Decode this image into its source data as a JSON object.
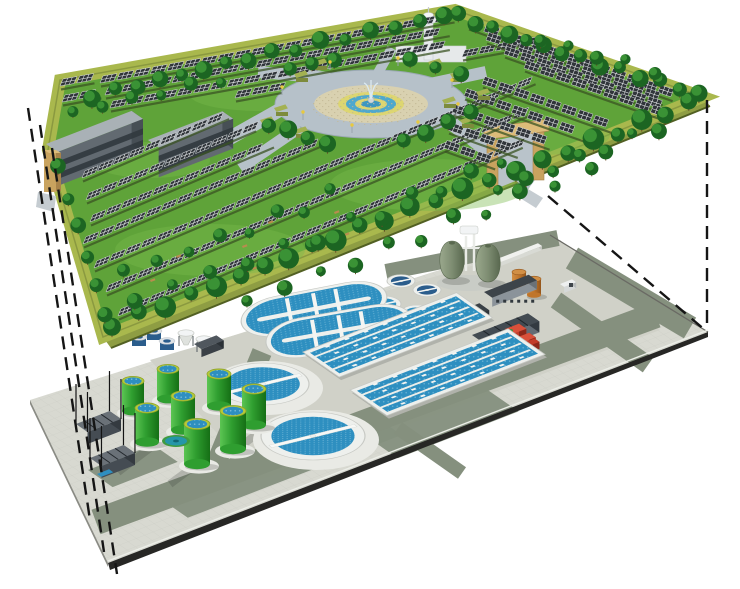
{
  "scene": {
    "title": "Exploded 3D rendering: ground-level solar park above an underground wastewater treatment plant, linked by dashed projection lines",
    "upper_level_label": "Ground level: solar-panel park with trees, central fountain plaza, office buildings and entrance gates",
    "lower_level_label": "Underground level: wastewater treatment plant with clarifiers, oxidation ditches, aeration basins, digesters and tanks"
  },
  "colors": {
    "sky": "#ffffff",
    "grass": "#5fa339",
    "grassLight": "#78b94c",
    "border": "#a9b84d",
    "borderSide": "#8a9940",
    "borderSideL": "#7b8a37",
    "borderDark": "#526023",
    "soil": "#3a5323",
    "panel": "#30353a",
    "panelGrid": "#eef0f2",
    "panelEdge": "#d7dadd",
    "treeDark": "#1c6522",
    "treeLight": "#3f9a38",
    "trunk": "#6b4a26",
    "plazaRing": "#b6c1c9",
    "plazaEdge": "#9aa8b3",
    "beige": "#d9d1b0",
    "beigeDot": "#c2b894",
    "yellow": "#ddd671",
    "blue1": "#4fa8cd",
    "blue2": "#3d97c0",
    "white": "#f2f4f5",
    "roofGray": "#a9b1b6",
    "faceGray": "#626a71",
    "sideGray": "#474f55",
    "windowDark": "#31383e",
    "tan": "#c9a35f",
    "tanDark": "#a8834a",
    "tanLight": "#ddbc79",
    "towerWhite": "#e8ebed",
    "towerShade": "#c6cccf",
    "pave": "#d8d9d1",
    "paveLine": "#c6c7bf",
    "paveMid": "#d0d1c8",
    "sage": "#85907e",
    "sageDark": "#707c6e",
    "slabEdge": "#272725",
    "slabSide": "#8a8b84",
    "cWhite": "#eef0ed",
    "cRim": "#c7c9c4",
    "water": "#2e8fc0",
    "waterDeep": "#24608c",
    "waterDot": "#a8d8ea",
    "tankGreen": "#2f9e30",
    "tankGreenD": "#156f15",
    "tankGreenL": "#5cc553",
    "tankRim": "#b5ca38",
    "egg": "#7e8d72",
    "eggD": "#59684f",
    "eggL": "#9aa88d",
    "pipe": "#e9ebe7",
    "orange": "#c0752a",
    "orangeD": "#94561c",
    "orangeL": "#d18f45",
    "red": "#c23b28",
    "redD": "#8e281a",
    "redTop": "#d9503a",
    "darkTop": "#6a7178",
    "darkFront": "#454c53",
    "darkSide": "#343a40",
    "navy": "#2b5d8c",
    "teal": "#2596a8",
    "tealRim": "#3f9a3f",
    "dash": "#151515",
    "shadow": "rgba(50,55,50,0.22)"
  },
  "upper": {
    "platform": {
      "pts": [
        [
          48,
          150
        ],
        [
          60,
          80
        ],
        [
          455,
          10
        ],
        [
          703,
          97
        ],
        [
          103,
          337
        ]
      ],
      "side_front": [
        [
          103,
          337
        ],
        [
          703,
          97
        ],
        [
          710,
          106
        ],
        [
          111,
          348
        ]
      ],
      "side_left": [
        [
          48,
          150
        ],
        [
          103,
          337
        ],
        [
          111,
          348
        ],
        [
          55,
          161
        ]
      ],
      "border_w": 12
    },
    "grass_patches": [
      [
        210,
        250,
        95,
        26
      ],
      [
        430,
        185,
        100,
        26
      ],
      [
        540,
        135,
        70,
        20
      ],
      [
        260,
        95,
        70,
        16
      ],
      [
        150,
        160,
        60,
        18
      ]
    ],
    "rows": {
      "F": {
        "dir": [
          0.92,
          -0.39
        ],
        "list": [
          [
            118,
            316,
            440
          ],
          [
            106,
            292,
            470
          ],
          [
            94,
            268,
            480
          ],
          [
            83,
            244,
            260
          ],
          [
            90,
            222,
            200
          ],
          [
            86,
            200,
            185
          ],
          [
            82,
            178,
            160
          ]
        ]
      },
      "B": {
        "dir": [
          0.985,
          -0.178
        ],
        "list": [
          [
            100,
            83,
            360
          ],
          [
            105,
            95,
            350
          ],
          [
            110,
            108,
            345
          ],
          [
            235,
            98,
            48
          ],
          [
            462,
            57,
            86
          ],
          [
            62,
            102,
            40
          ],
          [
            60,
            86,
            35
          ]
        ]
      },
      "R": {
        "dir": [
          0.93,
          0.326
        ],
        "list": [
          [
            468,
            26,
            220
          ],
          [
            486,
            40,
            190
          ],
          [
            504,
            54,
            170
          ],
          [
            524,
            68,
            150
          ],
          [
            482,
            84,
            145
          ],
          [
            464,
            96,
            130
          ],
          [
            452,
            112,
            105
          ],
          [
            448,
            130,
            75
          ],
          [
            444,
            148,
            55
          ]
        ]
      }
    },
    "panel_step": 17,
    "trees": [
      [
        112,
        324,
        690,
        103,
        24,
        7,
        11,
        4
      ],
      [
        56,
        168,
        104,
        315,
        6,
        6,
        8,
        3
      ],
      [
        88,
        96,
        440,
        16,
        16,
        6,
        9,
        4
      ],
      [
        455,
        16,
        695,
        94,
        14,
        6,
        9,
        4
      ],
      [
        268,
        124,
        330,
        144,
        4,
        7,
        9,
        3
      ],
      [
        405,
        142,
        474,
        112,
        4,
        7,
        9,
        3
      ],
      [
        292,
        68,
        336,
        60,
        3,
        6,
        8,
        2
      ],
      [
        412,
        60,
        462,
        74,
        3,
        6,
        8,
        2
      ],
      [
        140,
        298,
        510,
        162,
        12,
        5,
        8,
        10
      ],
      [
        122,
        272,
        330,
        195,
        8,
        5,
        7,
        9
      ],
      [
        240,
        300,
        600,
        170,
        11,
        5,
        8,
        9
      ],
      [
        492,
        190,
        664,
        127,
        7,
        5,
        8,
        6
      ],
      [
        70,
        112,
        225,
        80,
        6,
        5,
        7,
        4
      ],
      [
        540,
        40,
        660,
        70,
        5,
        5,
        7,
        5
      ]
    ],
    "plaza": {
      "cx": 371,
      "cy": 104,
      "rings": [
        [
          96,
          34,
          "plazaRing"
        ],
        [
          57,
          19,
          "beige"
        ],
        [
          33,
          12,
          "yellow"
        ],
        [
          25,
          9,
          "blue1"
        ],
        [
          16,
          5.8,
          "yellow"
        ],
        [
          10,
          3.6,
          "blue2"
        ]
      ]
    },
    "paths": [
      [
        330,
        78,
        258,
        72,
        12
      ],
      [
        430,
        84,
        486,
        72,
        12
      ],
      [
        300,
        127,
        240,
        168,
        12
      ],
      [
        447,
        120,
        532,
        184,
        14
      ],
      [
        378,
        73,
        392,
        48,
        10
      ],
      [
        292,
        103,
        212,
        148,
        14
      ]
    ],
    "hedges": [
      [
        315,
        62
      ],
      [
        296,
        74
      ],
      [
        430,
        62
      ],
      [
        452,
        74
      ],
      [
        276,
        108
      ],
      [
        296,
        130
      ],
      [
        444,
        100
      ],
      [
        462,
        120
      ],
      [
        262,
        120
      ],
      [
        478,
        92
      ]
    ],
    "lamps": [
      [
        303,
        120
      ],
      [
        352,
        133
      ],
      [
        418,
        130
      ],
      [
        458,
        112
      ],
      [
        330,
        70
      ],
      [
        398,
        66
      ],
      [
        282,
        95
      ],
      [
        452,
        88
      ]
    ],
    "benches": [
      [
        160,
        302
      ],
      [
        252,
        268
      ],
      [
        344,
        234
      ],
      [
        150,
        280
      ],
      [
        242,
        246
      ],
      [
        334,
        212
      ],
      [
        176,
        256
      ],
      [
        268,
        222
      ]
    ],
    "buildings": [
      [
        46,
        178,
        92,
        14,
        34
      ],
      [
        148,
        170,
        80,
        13,
        30
      ]
    ],
    "tower": {
      "shaft": [
        424,
        22,
        9,
        38
      ],
      "cap": [
        428.5,
        20,
        8,
        4
      ],
      "top": [
        428.5,
        15,
        5,
        2.5
      ],
      "spire": [
        428.5,
        7,
        428.5,
        14
      ]
    },
    "back_building": [
      396,
      46,
      70,
      16
    ],
    "gate_left": {
      "x": 44,
      "y": 150,
      "w": 12,
      "h": 42
    },
    "gate_right": {
      "p1": [
        487,
        140
      ],
      "p2": [
        533,
        132
      ],
      "pw": 11,
      "ph": 48,
      "lintel": [
        [
          484,
          128
        ],
        [
          549,
          119
        ],
        [
          549,
          131
        ],
        [
          484,
          140
        ]
      ]
    },
    "aprons": [
      [
        [
          518,
          183
        ],
        [
          543,
          198
        ],
        [
          536,
          208
        ],
        [
          512,
          193
        ]
      ],
      [
        [
          38,
          192
        ],
        [
          56,
          196
        ],
        [
          54,
          212
        ],
        [
          36,
          207
        ]
      ]
    ]
  },
  "lower": {
    "platform": {
      "pts": [
        [
          30,
          400
        ],
        [
          550,
          235
        ],
        [
          708,
          332
        ],
        [
          108,
          563
        ]
      ],
      "front_band": [
        [
          108,
          563
        ],
        [
          708,
          332
        ],
        [
          708,
          337
        ],
        [
          110,
          570
        ]
      ],
      "left_band": [
        [
          30,
          400
        ],
        [
          108,
          563
        ],
        [
          108,
          567
        ],
        [
          30,
          404
        ]
      ]
    },
    "pad": [
      [
        150,
        360
      ],
      [
        560,
        240
      ],
      [
        660,
        330
      ],
      [
        260,
        480
      ]
    ],
    "roads": [
      [
        96,
        522,
        656,
        315,
        26
      ],
      [
        210,
        478,
        262,
        352,
        20
      ],
      [
        386,
        272,
        558,
        238,
        16
      ],
      [
        572,
        258,
        690,
        328,
        24
      ],
      [
        556,
        300,
        648,
        365,
        18
      ],
      [
        398,
        428,
        462,
        473,
        14
      ]
    ],
    "patches": [
      [
        155,
        495,
        230,
        40
      ],
      [
        360,
        432,
        130,
        46
      ],
      [
        88,
        470,
        70,
        30
      ]
    ],
    "shadow_streaks": [
      [
        150,
        448,
        118,
        472
      ],
      [
        205,
        458,
        170,
        484
      ],
      [
        262,
        430,
        228,
        456
      ]
    ],
    "clarifiers": [
      [
        263,
        384,
        46,
        21
      ],
      [
        313,
        436,
        52,
        24
      ]
    ],
    "ditches": [
      [
        314,
        309,
        -11
      ],
      [
        339,
        331,
        -10
      ]
    ],
    "ditch_size": [
      148,
      19
    ],
    "small_clarifiers": [
      [
        401,
        281,
        14,
        "navy"
      ],
      [
        427,
        290,
        14,
        "navy"
      ],
      [
        384,
        304,
        17,
        "water"
      ],
      [
        417,
        313,
        17,
        "water"
      ]
    ],
    "basins": [
      [
        303,
        352,
        165,
        44
      ],
      [
        350,
        390,
        170,
        45
      ]
    ],
    "green_tanks": [
      [
        168,
        369,
        11,
        30
      ],
      [
        219,
        374,
        12,
        32
      ],
      [
        133,
        381,
        11,
        30
      ],
      [
        254,
        389,
        12,
        36
      ],
      [
        183,
        396,
        12,
        34
      ],
      [
        147,
        408,
        12,
        34
      ],
      [
        233,
        411,
        13,
        38
      ],
      [
        197,
        424,
        13,
        40
      ]
    ],
    "eggs": [
      [
        452,
        262
      ],
      [
        488,
        265
      ]
    ],
    "egg_pad": [
      469,
      283,
      32,
      8
    ],
    "pipes": {
      "v": [
        [
          466,
          236,
          466,
          271
        ],
        [
          474,
          232,
          474,
          271
        ]
      ],
      "h": [
        [
          448,
          248,
          492,
          248
        ]
      ],
      "box": [
        460,
        226,
        18,
        8
      ]
    },
    "orange_tanks": [
      [
        519,
        272,
        7,
        16
      ],
      [
        534,
        279,
        7,
        16
      ]
    ],
    "buildings": [
      {
        "b": [
          484,
          301,
          48,
          10,
          9
        ],
        "top": "#3d444a",
        "front": "#8b939a",
        "side": "#6a7177",
        "win": true
      },
      {
        "b": [
          444,
          327,
          38,
          12,
          10
        ],
        "top": "#3a4147",
        "front": "#59616a",
        "side": "#2e343a",
        "win": false
      },
      {
        "b": [
          472,
          346,
          60,
          14,
          11
        ],
        "top": "#434b52",
        "front": "#636c75",
        "side": "#333a41",
        "win": false
      }
    ],
    "white_wall": [
      497,
      263,
      44,
      5,
      4
    ],
    "truck": [
      560,
      290,
      13,
      5,
      6
    ],
    "red_pump": {
      "a": [
        505,
        342,
        15,
        9,
        13
      ],
      "b": [
        518,
        346,
        12,
        8,
        9
      ],
      "c": [
        528,
        348,
        7,
        6,
        7
      ]
    },
    "navy_cyls": [
      [
        139,
        337,
        7,
        9
      ],
      [
        154,
        331,
        7,
        9
      ],
      [
        167,
        341,
        7,
        9
      ]
    ],
    "hoppers": [
      [
        186,
        333
      ],
      [
        204,
        339
      ]
    ],
    "dark_box": [
      194,
      352,
      24,
      9,
      8
    ],
    "teal_pool": [
      176,
      441
    ],
    "intakes": [
      [
        76,
        436,
        36,
        14,
        12
      ],
      [
        90,
        470,
        36,
        14,
        12
      ]
    ],
    "pole_h": 40,
    "blue_pad": [
      97,
      474,
      13,
      5
    ]
  },
  "projection_lines": {
    "left": [
      [
        28,
        108,
        90,
        520
      ],
      [
        40,
        125,
        104,
        552
      ],
      [
        52,
        148,
        117,
        574
      ]
    ],
    "right": [
      [
        707,
        100,
        707,
        329
      ],
      [
        548,
        196,
        706,
        331
      ]
    ],
    "dash": "13 8",
    "width": 2.4
  }
}
